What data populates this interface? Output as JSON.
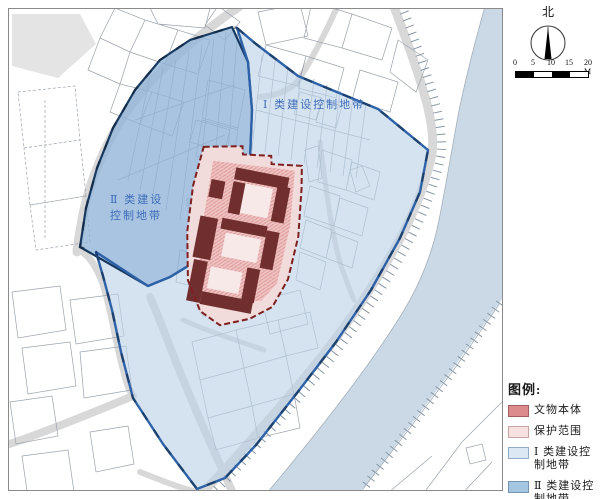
{
  "map": {
    "labels": {
      "zone1": "Ⅰ 类建设控制地带",
      "zone2_line1": "Ⅱ 类建设",
      "zone2_line2": "控制地带"
    },
    "label_color": "#3E6CB8"
  },
  "compass": {
    "label": "北"
  },
  "scalebar": {
    "labels": [
      "0",
      "5",
      "10",
      "15",
      "20 M"
    ]
  },
  "legend": {
    "title": "图例:",
    "items": [
      {
        "label": "文物本体",
        "color": "#DC8C8C",
        "border": "#A06060"
      },
      {
        "label": "保护范围",
        "color": "#F7E2E2",
        "border": "#C8A4A4"
      },
      {
        "label": "Ⅰ 类建设控",
        "label2": "制地带",
        "color": "#DCE9F5",
        "border": "#93ACC5"
      },
      {
        "label": "Ⅱ 类建设控",
        "label2": "制地带",
        "color": "#A5C6E1",
        "border": "#7693B0"
      }
    ]
  },
  "colors": {
    "zone1_fill": "#BBD2E9",
    "zone2_fill": "#8FB4D8",
    "zone1_border": "#2D62A8",
    "zone2_border": "#17395F",
    "protection_fill": "#F2DBDB",
    "protection_border": "#7E2020",
    "relic_fill": "#702E2E",
    "courtyard_fill": "#F8E9E9",
    "river_fill": "#CBD9E6",
    "road_fill": "#D8D8D8",
    "frame_border": "#8A8A8A"
  }
}
